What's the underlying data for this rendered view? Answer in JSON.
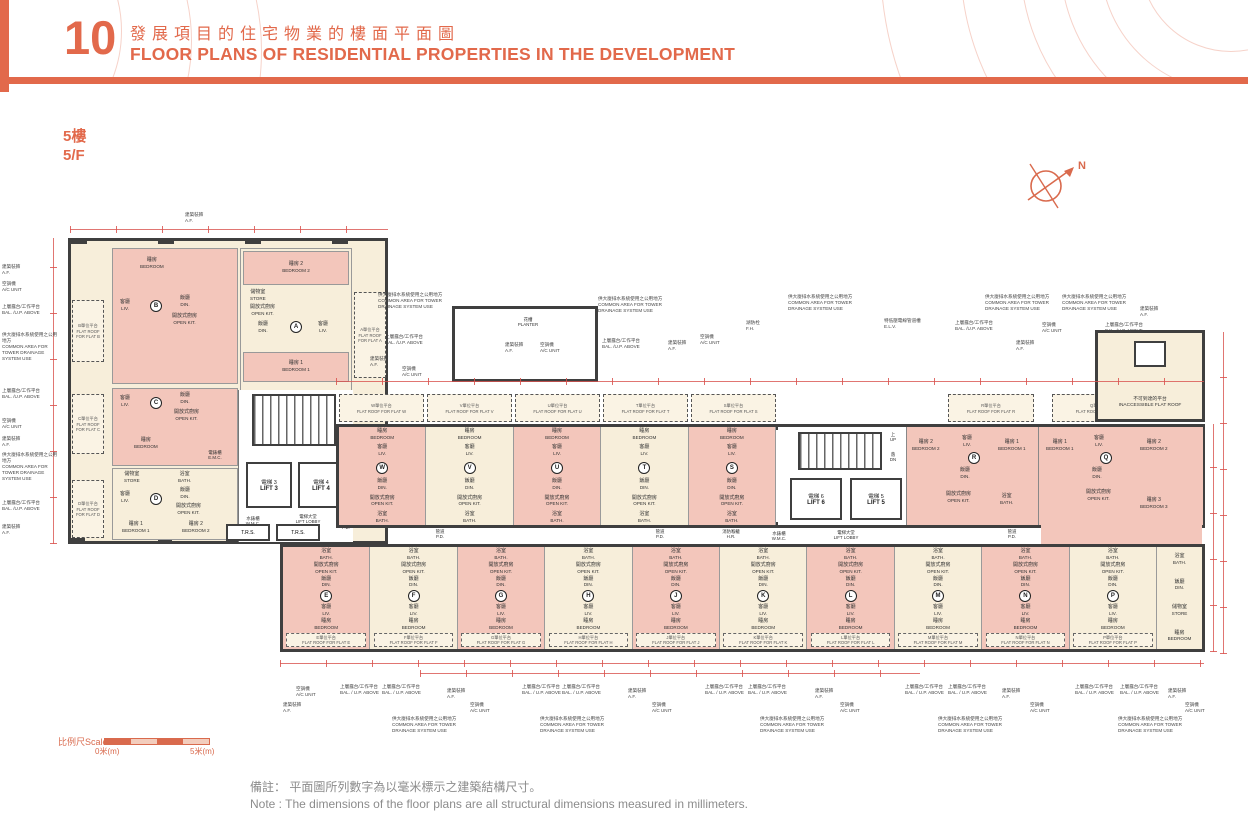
{
  "header": {
    "number": "10",
    "title_zh": "發展項目的住宅物業的樓面平面圖",
    "title_en": "FLOOR PLANS OF RESIDENTIAL PROPERTIES IN THE DEVELOPMENT"
  },
  "floor": {
    "zh": "5樓",
    "en": "5/F"
  },
  "compass": {
    "north": "N"
  },
  "rooms": {
    "bedroom": {
      "zh": "睡房",
      "en": "BEDROOM"
    },
    "bedroom1": {
      "zh": "睡房 1",
      "en": "BEDROOM 1"
    },
    "bedroom2": {
      "zh": "睡房 2",
      "en": "BEDROOM 2"
    },
    "bedroom3": {
      "zh": "睡房 3",
      "en": "BEDROOM 3"
    },
    "living": {
      "zh": "客廳",
      "en": "LIV."
    },
    "dining": {
      "zh": "飯廳",
      "en": "DIN."
    },
    "open_kitchen": {
      "zh": "開放式廚房",
      "en": "OPEN KIT."
    },
    "bath": {
      "zh": "浴室",
      "en": "BATH."
    },
    "store": {
      "zh": "儲物室",
      "en": "STORE"
    },
    "up": {
      "zh": "上",
      "en": "UP"
    },
    "down": {
      "zh": "落",
      "en": "DN"
    }
  },
  "facilities": {
    "lift3": {
      "zh": "電梯 3",
      "en": "LIFT 3"
    },
    "lift4": {
      "zh": "電梯 4",
      "en": "LIFT 4"
    },
    "lift5": {
      "zh": "電梯 5",
      "en": "LIFT 5"
    },
    "lift6": {
      "zh": "電梯 6",
      "en": "LIFT 6"
    },
    "lift_lobby": {
      "zh": "電梯大堂",
      "en": "LIFT LOBBY"
    },
    "trs": "T.R.S.",
    "wmc": {
      "zh": "水錶櫃",
      "en": "W.M.C."
    },
    "pd": {
      "zh": "管道",
      "en": "P.D."
    },
    "emr": {
      "zh": "電錶房",
      "en": "E.M.R."
    },
    "emc": {
      "zh": "電錶櫃",
      "en": "E.M.C."
    },
    "hr": {
      "zh": "消防喉轆",
      "en": "H.R."
    }
  },
  "units": {
    "a": {
      "id": "A",
      "roof_zh": "A單位平台",
      "roof_en": "FLAT ROOF FOR FLAT A"
    },
    "b": {
      "id": "B",
      "roof_zh": "B單位平台",
      "roof_en": "FLAT ROOF FOR FLAT B"
    },
    "c": {
      "id": "C",
      "roof_zh": "C單位平台",
      "roof_en": "FLAT ROOF FOR FLAT C"
    },
    "d": {
      "id": "D",
      "roof_zh": "D單位平台",
      "roof_en": "FLAT ROOF FOR FLAT D"
    },
    "r": {
      "id": "R",
      "roof_zh": "R單位平台",
      "roof_en": "FLAT ROOF FOR FLAT R"
    },
    "q": {
      "id": "Q",
      "roof_zh": "Q單位平台",
      "roof_en": "FLAT ROOF FOR FLAT Q"
    }
  },
  "top_row_units": [
    {
      "id": "W",
      "cls": "pink",
      "roof_zh": "W單位平台",
      "roof_en": "FLAT ROOF FOR FLAT W"
    },
    {
      "id": "V",
      "cls": "cream",
      "roof_zh": "V單位平台",
      "roof_en": "FLAT ROOF FOR FLAT V"
    },
    {
      "id": "U",
      "cls": "pink",
      "roof_zh": "U單位平台",
      "roof_en": "FLAT ROOF FOR FLAT U"
    },
    {
      "id": "T",
      "cls": "cream",
      "roof_zh": "T單位平台",
      "roof_en": "FLAT ROOF FOR FLAT T"
    },
    {
      "id": "S",
      "cls": "pink",
      "roof_zh": "S單位平台",
      "roof_en": "FLAT ROOF FOR FLAT S"
    }
  ],
  "bottom_row_units": [
    {
      "id": "E",
      "cls": "pink",
      "roof_zh": "E單位平台",
      "roof_en": "FLAT ROOF FOR FLAT E"
    },
    {
      "id": "F",
      "cls": "cream",
      "roof_zh": "F單位平台",
      "roof_en": "FLAT ROOF FOR FLAT F"
    },
    {
      "id": "G",
      "cls": "pink",
      "roof_zh": "G單位平台",
      "roof_en": "FLAT ROOF FOR FLAT G"
    },
    {
      "id": "H",
      "cls": "cream",
      "roof_zh": "H單位平台",
      "roof_en": "FLAT ROOF FOR FLAT H"
    },
    {
      "id": "J",
      "cls": "pink",
      "roof_zh": "J單位平台",
      "roof_en": "FLAT ROOF FOR FLAT J"
    },
    {
      "id": "K",
      "cls": "cream",
      "roof_zh": "K單位平台",
      "roof_en": "FLAT ROOF FOR FLAT K"
    },
    {
      "id": "L",
      "cls": "pink",
      "roof_zh": "L單位平台",
      "roof_en": "FLAT ROOF FOR FLAT L"
    },
    {
      "id": "M",
      "cls": "cream",
      "roof_zh": "M單位平台",
      "roof_en": "FLAT ROOF FOR FLAT M"
    },
    {
      "id": "N",
      "cls": "pink",
      "roof_zh": "N單位平台",
      "roof_en": "FLAT ROOF FOR FLAT N"
    },
    {
      "id": "P",
      "cls": "cream",
      "roof_zh": "P單位平台",
      "roof_en": "FLAT ROOF FOR FLAT P"
    }
  ],
  "inaccessible_roof": {
    "zh": "不可到達的平台",
    "en": "INACCESSIBLE FLAT ROOF"
  },
  "annotations": {
    "planter": {
      "zh": "花槽",
      "en": "PLANTER"
    }
  },
  "callouts_top": [
    {
      "x": 185,
      "y": 212,
      "zh": "建築裝飾",
      "en": "A.F."
    },
    {
      "x": 378,
      "y": 292,
      "w": 82,
      "zh": "供大廈排水系統使用之公用地方",
      "en": "COMMON AREA FOR TOWER DRAINAGE SYSTEM USE"
    },
    {
      "x": 385,
      "y": 334,
      "w": 46,
      "zh": "上層露台/工作平台",
      "en": "BAL. /U.P. ABOVE"
    },
    {
      "x": 370,
      "y": 356,
      "zh": "建築裝飾",
      "en": "A.F."
    },
    {
      "x": 402,
      "y": 366,
      "zh": "空調機",
      "en": "A/C UNIT"
    },
    {
      "x": 505,
      "y": 342,
      "zh": "建築裝飾",
      "en": "A.F."
    },
    {
      "x": 540,
      "y": 342,
      "zh": "空調機",
      "en": "A/C UNIT"
    },
    {
      "x": 598,
      "y": 296,
      "w": 82,
      "zh": "供大廈排水系統使用之公用地方",
      "en": "COMMON AREA FOR TOWER DRAINAGE SYSTEM USE"
    },
    {
      "x": 602,
      "y": 338,
      "w": 46,
      "zh": "上層露台/工作平台",
      "en": "BAL. /U.P. ABOVE"
    },
    {
      "x": 668,
      "y": 340,
      "zh": "建築裝飾",
      "en": "A.F."
    },
    {
      "x": 700,
      "y": 334,
      "zh": "空調機",
      "en": "A/C UNIT"
    },
    {
      "x": 746,
      "y": 320,
      "zh": "湖防栓",
      "en": "F.H."
    },
    {
      "x": 788,
      "y": 294,
      "w": 82,
      "zh": "供大廈排水系統使用之公用地方",
      "en": "COMMON AREA FOR TOWER DRAINAGE SYSTEM USE"
    },
    {
      "x": 884,
      "y": 318,
      "w": 70,
      "zh": "特低壓電線管道槽",
      "en": "E.L.V."
    },
    {
      "x": 955,
      "y": 320,
      "w": 46,
      "zh": "上層露台/工作平台",
      "en": "BAL. /U.P. ABOVE"
    },
    {
      "x": 985,
      "y": 294,
      "w": 82,
      "zh": "供大廈排水系統使用之公用地方",
      "en": "COMMON AREA FOR TOWER DRAINAGE SYSTEM USE"
    },
    {
      "x": 1016,
      "y": 340,
      "zh": "建築裝飾",
      "en": "A.F."
    },
    {
      "x": 1042,
      "y": 322,
      "zh": "空調機",
      "en": "A/C UNIT"
    },
    {
      "x": 1062,
      "y": 294,
      "w": 82,
      "zh": "供大廈排水系統使用之公用地方",
      "en": "COMMON AREA FOR TOWER DRAINAGE SYSTEM USE"
    },
    {
      "x": 1105,
      "y": 322,
      "w": 46,
      "zh": "上層露台/工作平台",
      "en": "BAL. /U.P. ABOVE"
    },
    {
      "x": 1140,
      "y": 306,
      "zh": "建築裝飾",
      "en": "A.F."
    }
  ],
  "callouts_left": [
    {
      "x": 2,
      "y": 264,
      "w": 56,
      "zh": "建築裝飾",
      "en": "A.F."
    },
    {
      "x": 2,
      "y": 281,
      "w": 56,
      "zh": "空調機",
      "en": "A/C UNIT"
    },
    {
      "x": 2,
      "y": 304,
      "w": 56,
      "zh": "上層露台/工作平台",
      "en": "BAL. /U.P. ABOVE"
    },
    {
      "x": 2,
      "y": 332,
      "w": 58,
      "zh": "供大廈排水系統使用之公用地方",
      "en": "COMMON AREA FOR TOWER DRAINAGE SYSTEM USE"
    },
    {
      "x": 2,
      "y": 388,
      "w": 56,
      "zh": "上層露台/工作平台",
      "en": "BAL. /U.P. ABOVE"
    },
    {
      "x": 2,
      "y": 418,
      "w": 56,
      "zh": "空調機",
      "en": "A/C UNIT"
    },
    {
      "x": 2,
      "y": 436,
      "w": 56,
      "zh": "建築裝飾",
      "en": "A.F."
    },
    {
      "x": 2,
      "y": 452,
      "w": 58,
      "zh": "供大廈排水系統使用之公用地方",
      "en": "COMMON AREA FOR TOWER DRAINAGE SYSTEM USE"
    },
    {
      "x": 2,
      "y": 500,
      "w": 56,
      "zh": "上層露台/工作平台",
      "en": "BAL. /U.P. ABOVE"
    },
    {
      "x": 2,
      "y": 524,
      "w": 56,
      "zh": "建築裝飾",
      "en": "A.F."
    }
  ],
  "callouts_bottom": [
    {
      "x": 296,
      "y": 686,
      "zh": "空調機",
      "en": "A/C UNIT"
    },
    {
      "x": 283,
      "y": 702,
      "zh": "建築裝飾",
      "en": "A.F."
    },
    {
      "x": 340,
      "y": 684,
      "w": 40,
      "zh": "上層露台/工作平台",
      "en": "BAL. / U.P. ABOVE"
    },
    {
      "x": 382,
      "y": 684,
      "w": 40,
      "zh": "上層露台/工作平台",
      "en": "BAL. / U.P. ABOVE"
    },
    {
      "x": 447,
      "y": 688,
      "zh": "建築裝飾",
      "en": "A.F."
    },
    {
      "x": 470,
      "y": 702,
      "zh": "空調機",
      "en": "A/C UNIT"
    },
    {
      "x": 392,
      "y": 716,
      "w": 84,
      "zh": "供大廈排水系統使用之公用地方",
      "en": "COMMON AREA FOR TOWER DRAINAGE SYSTEM USE"
    },
    {
      "x": 522,
      "y": 684,
      "w": 40,
      "zh": "上層露台/工作平台",
      "en": "BAL. / U.P. ABOVE"
    },
    {
      "x": 562,
      "y": 684,
      "w": 40,
      "zh": "上層露台/工作平台",
      "en": "BAL. / U.P. ABOVE"
    },
    {
      "x": 628,
      "y": 688,
      "zh": "建築裝飾",
      "en": "A.F."
    },
    {
      "x": 652,
      "y": 702,
      "zh": "空調機",
      "en": "A/C UNIT"
    },
    {
      "x": 540,
      "y": 716,
      "w": 84,
      "zh": "供大廈排水系統使用之公用地方",
      "en": "COMMON AREA FOR TOWER DRAINAGE SYSTEM USE"
    },
    {
      "x": 705,
      "y": 684,
      "w": 40,
      "zh": "上層露台/工作平台",
      "en": "BAL. / U.P. ABOVE"
    },
    {
      "x": 748,
      "y": 684,
      "w": 40,
      "zh": "上層露台/工作平台",
      "en": "BAL. / U.P. ABOVE"
    },
    {
      "x": 815,
      "y": 688,
      "zh": "建築裝飾",
      "en": "A.F."
    },
    {
      "x": 840,
      "y": 702,
      "zh": "空調機",
      "en": "A/C UNIT"
    },
    {
      "x": 760,
      "y": 716,
      "w": 84,
      "zh": "供大廈排水系統使用之公用地方",
      "en": "COMMON AREA FOR TOWER DRAINAGE SYSTEM USE"
    },
    {
      "x": 905,
      "y": 684,
      "w": 40,
      "zh": "上層露台/工作平台",
      "en": "BAL. / U.P. ABOVE"
    },
    {
      "x": 948,
      "y": 684,
      "w": 40,
      "zh": "上層露台/工作平台",
      "en": "BAL. / U.P. ABOVE"
    },
    {
      "x": 1002,
      "y": 688,
      "zh": "建築裝飾",
      "en": "A.F."
    },
    {
      "x": 1030,
      "y": 702,
      "zh": "空調機",
      "en": "A/C UNIT"
    },
    {
      "x": 938,
      "y": 716,
      "w": 84,
      "zh": "供大廈排水系統使用之公用地方",
      "en": "COMMON AREA FOR TOWER DRAINAGE SYSTEM USE"
    },
    {
      "x": 1075,
      "y": 684,
      "w": 40,
      "zh": "上層露台/工作平台",
      "en": "BAL. / U.P. ABOVE"
    },
    {
      "x": 1120,
      "y": 684,
      "w": 40,
      "zh": "上層露台/工作平台",
      "en": "BAL. / U.P. ABOVE"
    },
    {
      "x": 1118,
      "y": 716,
      "w": 84,
      "zh": "供大廈排水系統使用之公用地方",
      "en": "COMMON AREA FOR TOWER DRAINAGE SYSTEM USE"
    },
    {
      "x": 1168,
      "y": 688,
      "zh": "建築裝飾",
      "en": "A.F."
    },
    {
      "x": 1185,
      "y": 702,
      "zh": "空調機",
      "en": "A/C UNIT"
    }
  ],
  "scale_bar": {
    "label": "比例尺Scale",
    "zero": "0米(m)",
    "five": "5米(m)"
  },
  "notes": {
    "zh": "備註： 平面圖所列數字為以毫米標示之建築結構尺寸。",
    "en": "Note :  The dimensions of the floor plans are all structural dimensions measured in millimeters."
  }
}
